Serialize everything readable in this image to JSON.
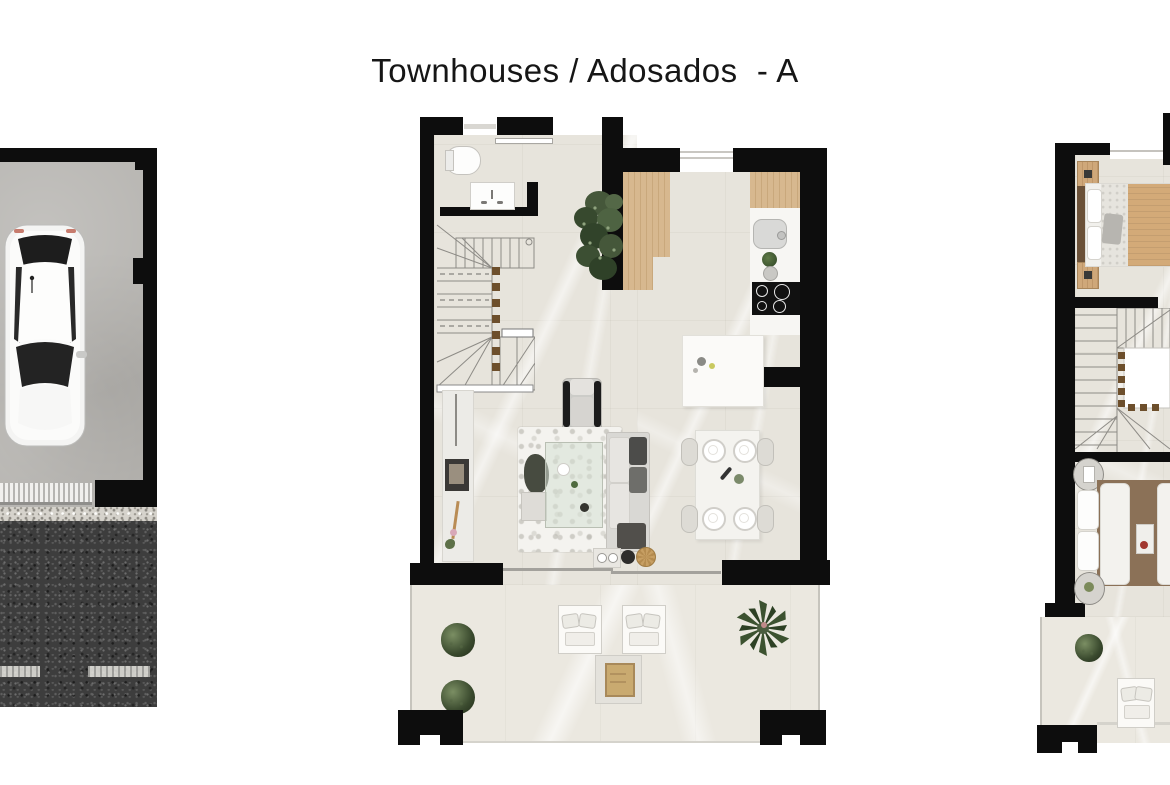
{
  "title": "Townhouses / Adosados  - A",
  "colors": {
    "wall": "#0d0d0d",
    "floor_marble": "#e7e4dc",
    "floor_terrace": "#ebe8e0",
    "concrete": "#b4b2ae",
    "asphalt": "#3d3d3d",
    "wood": "#d7b88f",
    "wood_dark": "#6b5138",
    "counter": "#f7f6f3",
    "bed_tan": "#d3aa78",
    "bed_brown": "#8b7157",
    "plant_green": "#44543a",
    "accent_red": "#a23830"
  },
  "plans": {
    "garage": {
      "label": "garage-plan",
      "items": [
        "car-top-view",
        "garage-door",
        "gravel-strip",
        "driveway-asphalt",
        "road-dashed-marking"
      ]
    },
    "ground_floor": {
      "label": "ground-floor-plan",
      "items": [
        "entry-door",
        "bathroom-toilet",
        "bathroom-vanity",
        "staircase",
        "indoor-plant",
        "kitchen-wood-floor",
        "kitchen-cabinet",
        "kitchen-sink",
        "cooktop",
        "kitchen-island",
        "sideboard",
        "wall-art",
        "armchair",
        "rug",
        "coffee-table",
        "sofa",
        "dining-table",
        "dining-chairs",
        "sliding-glass-door",
        "terrace-shrubs",
        "terrace-plant",
        "sun-loungers",
        "terrace-table"
      ]
    },
    "upper_floor": {
      "label": "upper-floor-plan",
      "items": [
        "bedroom-1-bed",
        "nightstands",
        "window",
        "staircase",
        "stair-void",
        "bedroom-2-bed",
        "round-side-tables",
        "breakfast-tray",
        "balcony-shrub",
        "balcony-lounger"
      ]
    }
  }
}
